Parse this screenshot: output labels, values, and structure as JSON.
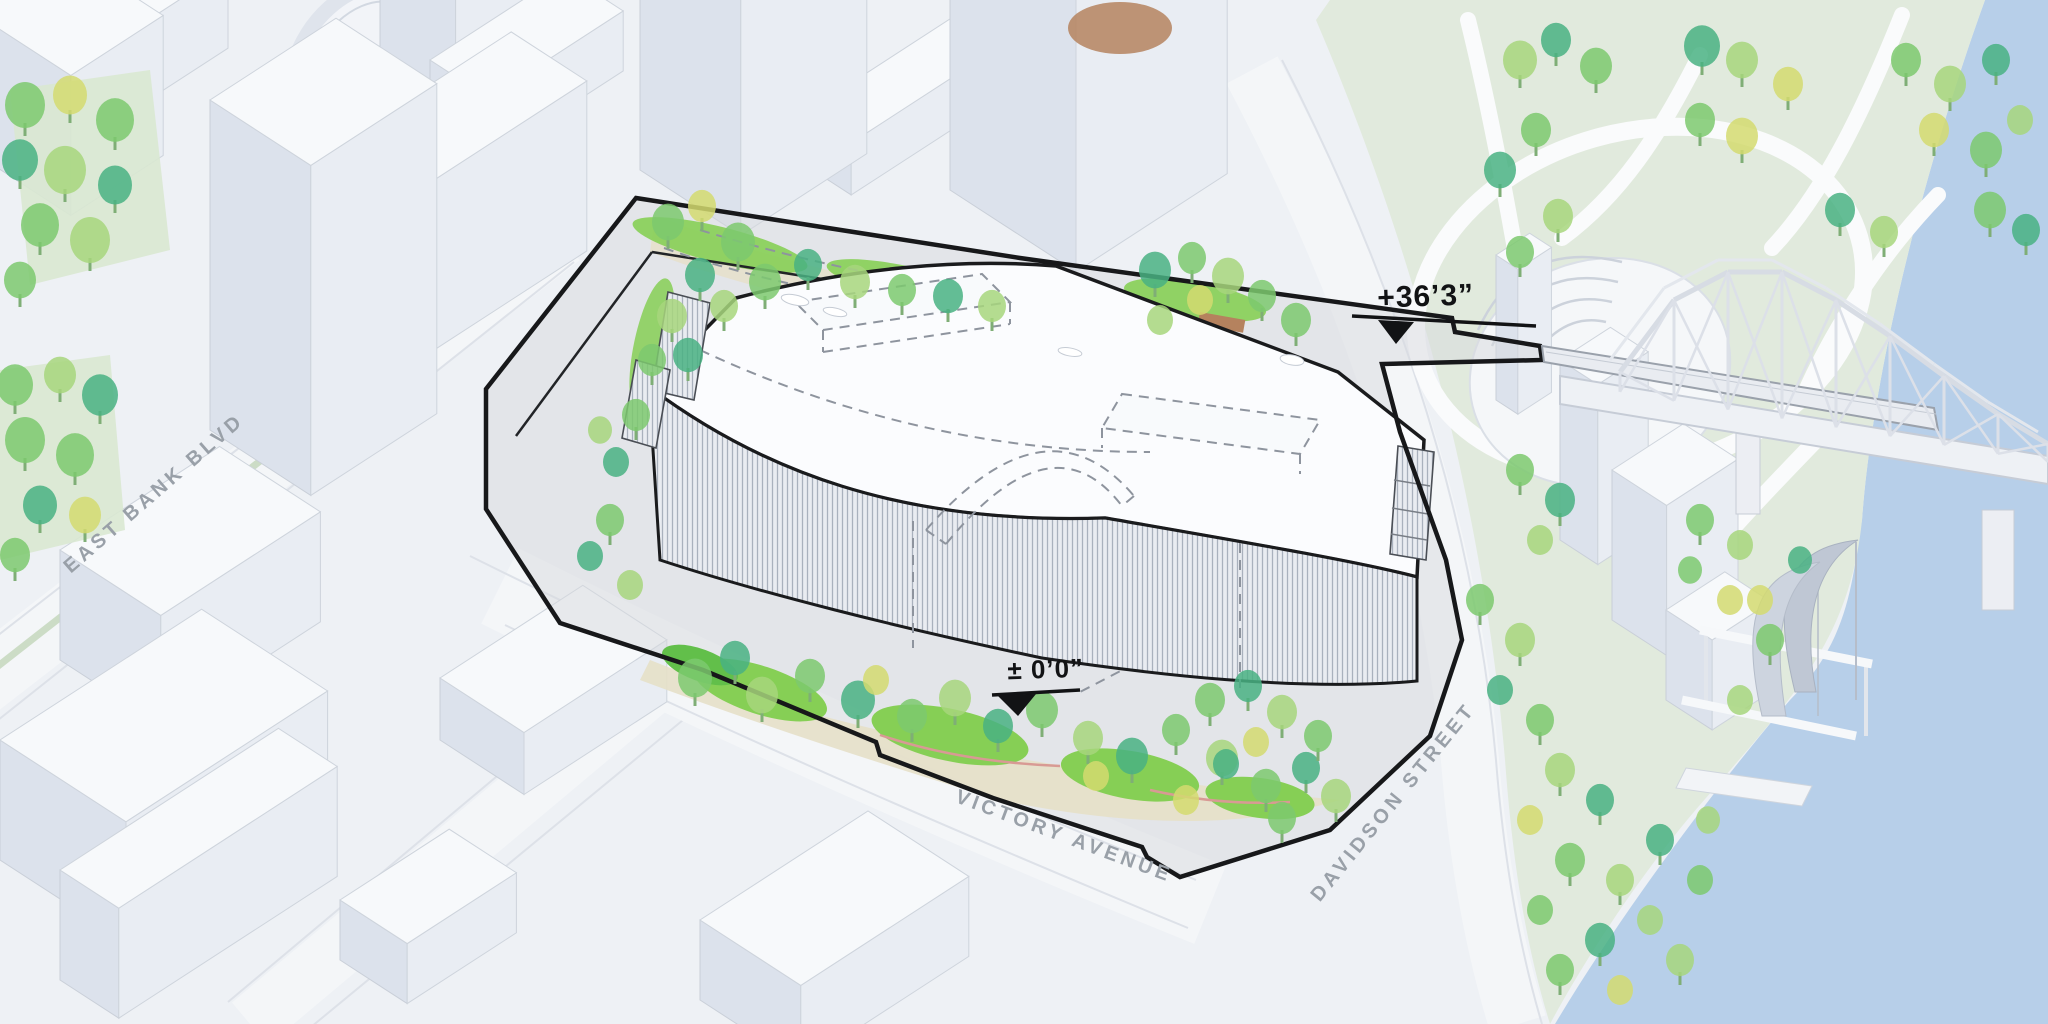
{
  "document": {
    "kind": "architectural-site-plan-illustration",
    "view": "axonometric aerial"
  },
  "streets": {
    "east_bank_blvd": "EAST BANK BLVD",
    "victory_avenue": "VICTORY AVENUE",
    "davidson_street": "DAVIDSON STREET"
  },
  "markers": {
    "upper_label": "+36’3”",
    "ground_label": "± 0’0”"
  },
  "palette": {
    "background": "#eef1f5",
    "water": "#b7cfe9",
    "park": "#e1eadd",
    "lawn": "#86cf55",
    "ground_tan": "#e6e0c8",
    "soil_brown": "#b5825e",
    "deck_gray": "#d7dade",
    "boundary_black": "#17181a",
    "roof_white": "#fbfcfe",
    "street_white": "#f4f6f8",
    "median_green": "#ccdcc6",
    "label_gray": "#99a0a8",
    "tree_colors": [
      "#49b182",
      "#7cc96e",
      "#a7d67c",
      "#d3da70",
      "#3fa873"
    ],
    "trunk_green": "#7fae76",
    "building_top": "#f7f9fb",
    "building_left": "#dce2ec",
    "building_right": "#e9edf3"
  }
}
